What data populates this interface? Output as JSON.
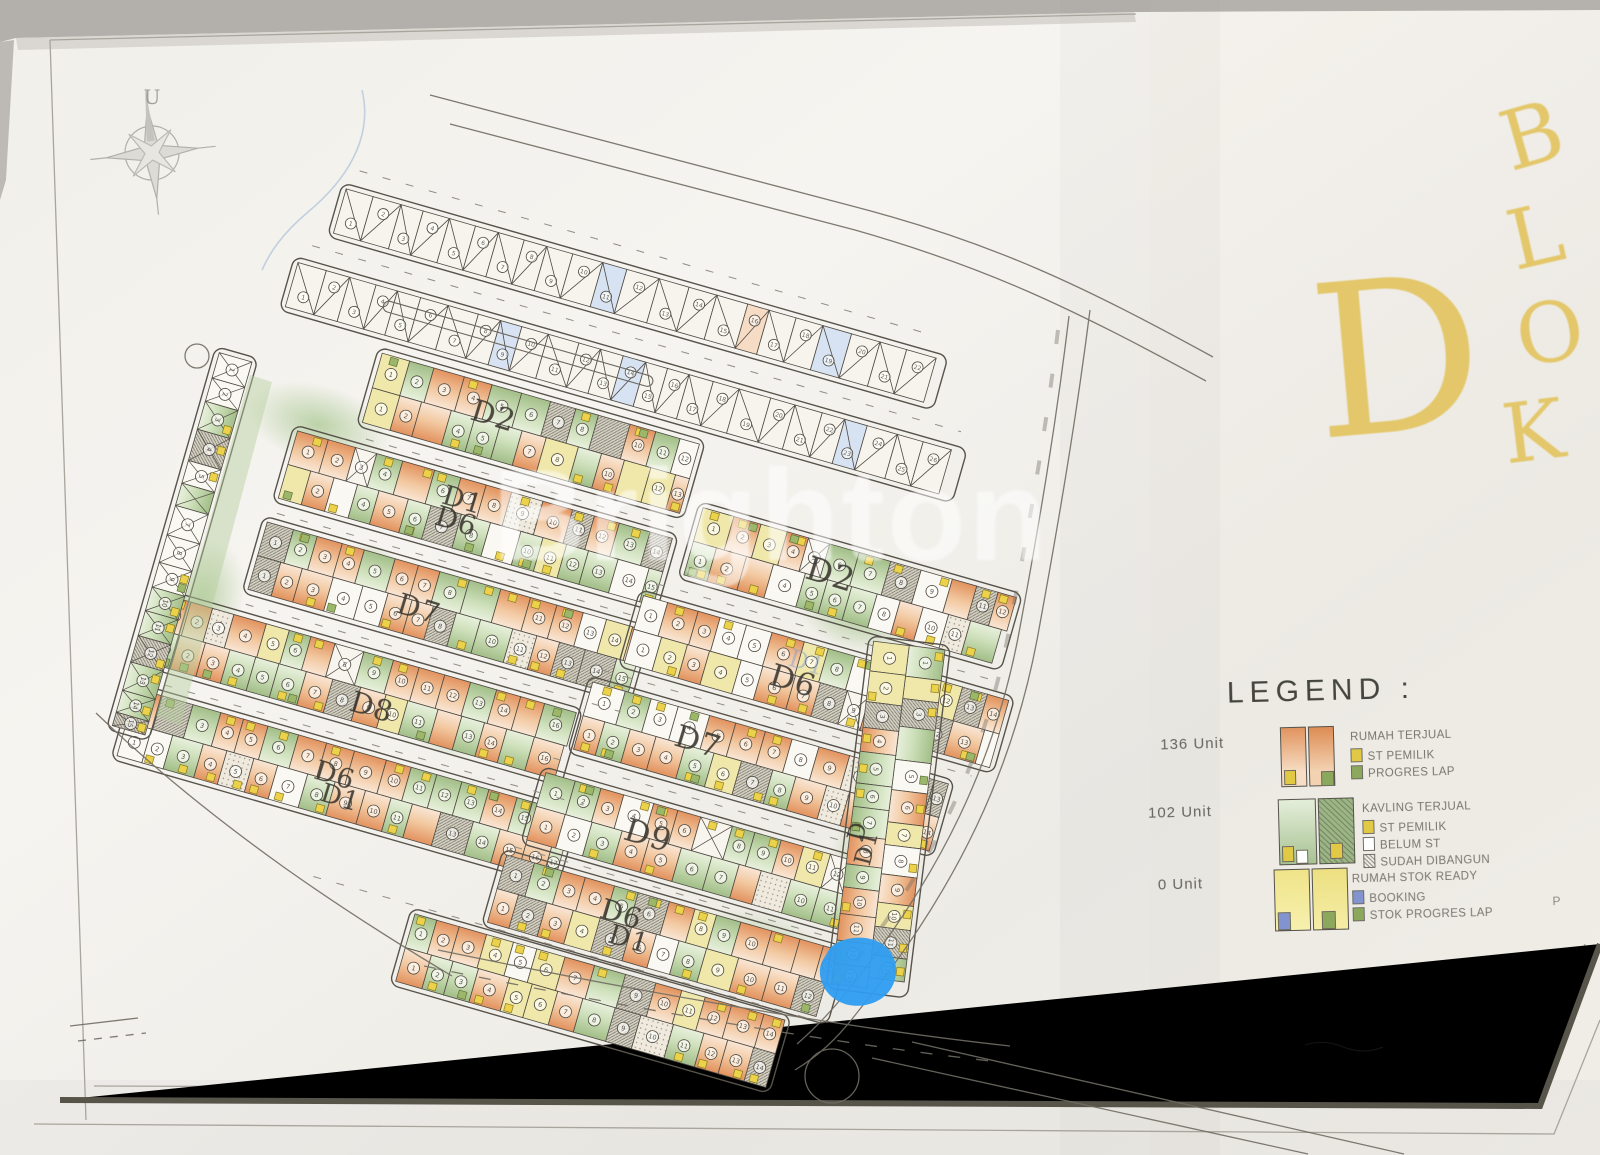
{
  "photo": {
    "description": "photograph of printed housing site plan sheet"
  },
  "title": {
    "big_letter": "D",
    "vertical_word": "BLOK",
    "color": "#e3c76a"
  },
  "compass": {
    "label": "U"
  },
  "watermark": {
    "text": "Brighton"
  },
  "legend": {
    "title": "LEGEND :",
    "entries": [
      {
        "units": "136 Unit",
        "swatch": "sold-orange",
        "lines": [
          {
            "text": "RUMAH TERJUAL"
          },
          {
            "square": "#e2c945",
            "text": "ST PEMILIK"
          },
          {
            "square": "#8ca85c",
            "text": "PROGRES LAP"
          }
        ]
      },
      {
        "units": "102 Unit",
        "swatch": "kavling-green",
        "lines": [
          {
            "text": "KAVLING TERJUAL"
          },
          {
            "square": "#e2c945",
            "text": "ST PEMILIK"
          },
          {
            "square": "#ffffff",
            "text": "BELUM ST"
          },
          {
            "square": "hatch",
            "text": "SUDAH DIBANGUN"
          }
        ]
      },
      {
        "units": "0 Unit",
        "swatch": "stock-yellow",
        "note": "P",
        "lines": [
          {
            "text": "RUMAH STOK READY"
          },
          {
            "square": "#8194cf",
            "text": "BOOKING"
          },
          {
            "square": "#8ca85c",
            "text": "STOK PROGRES LAP"
          }
        ]
      }
    ]
  },
  "plan": {
    "block_labels": [
      {
        "t": "D2",
        "x": 476,
        "y": 396,
        "r": 17,
        "s": 30
      },
      {
        "t": "D1",
        "x": 447,
        "y": 482,
        "r": 17,
        "s": 27
      },
      {
        "t": "D6",
        "x": 440,
        "y": 502,
        "r": 17,
        "s": 28
      },
      {
        "t": "D7",
        "x": 402,
        "y": 589,
        "r": 17,
        "s": 29
      },
      {
        "t": "D8",
        "x": 355,
        "y": 687,
        "r": 17,
        "s": 29
      },
      {
        "t": "D6",
        "x": 319,
        "y": 757,
        "r": 17,
        "s": 27
      },
      {
        "t": "D1",
        "x": 325,
        "y": 780,
        "r": 17,
        "s": 26
      },
      {
        "t": "D2",
        "x": 812,
        "y": 551,
        "r": 17,
        "s": 33
      },
      {
        "t": "D1",
        "x": 793,
        "y": 646,
        "r": 17,
        "s": 24,
        "ghost": true
      },
      {
        "t": "D6",
        "x": 775,
        "y": 660,
        "r": 17,
        "s": 31
      },
      {
        "t": "D7",
        "x": 680,
        "y": 721,
        "r": 17,
        "s": 31
      },
      {
        "t": "D9",
        "x": 630,
        "y": 813,
        "r": 17,
        "s": 32
      },
      {
        "t": "D6",
        "x": 605,
        "y": 895,
        "r": 17,
        "s": 28
      },
      {
        "t": "D1",
        "x": 613,
        "y": 921,
        "r": 17,
        "s": 27
      },
      {
        "t": "D",
        "x": 845,
        "y": 838,
        "r": -75,
        "s": 23
      },
      {
        "t": "D1",
        "x": 852,
        "y": 862,
        "r": -75,
        "s": 23
      }
    ]
  }
}
